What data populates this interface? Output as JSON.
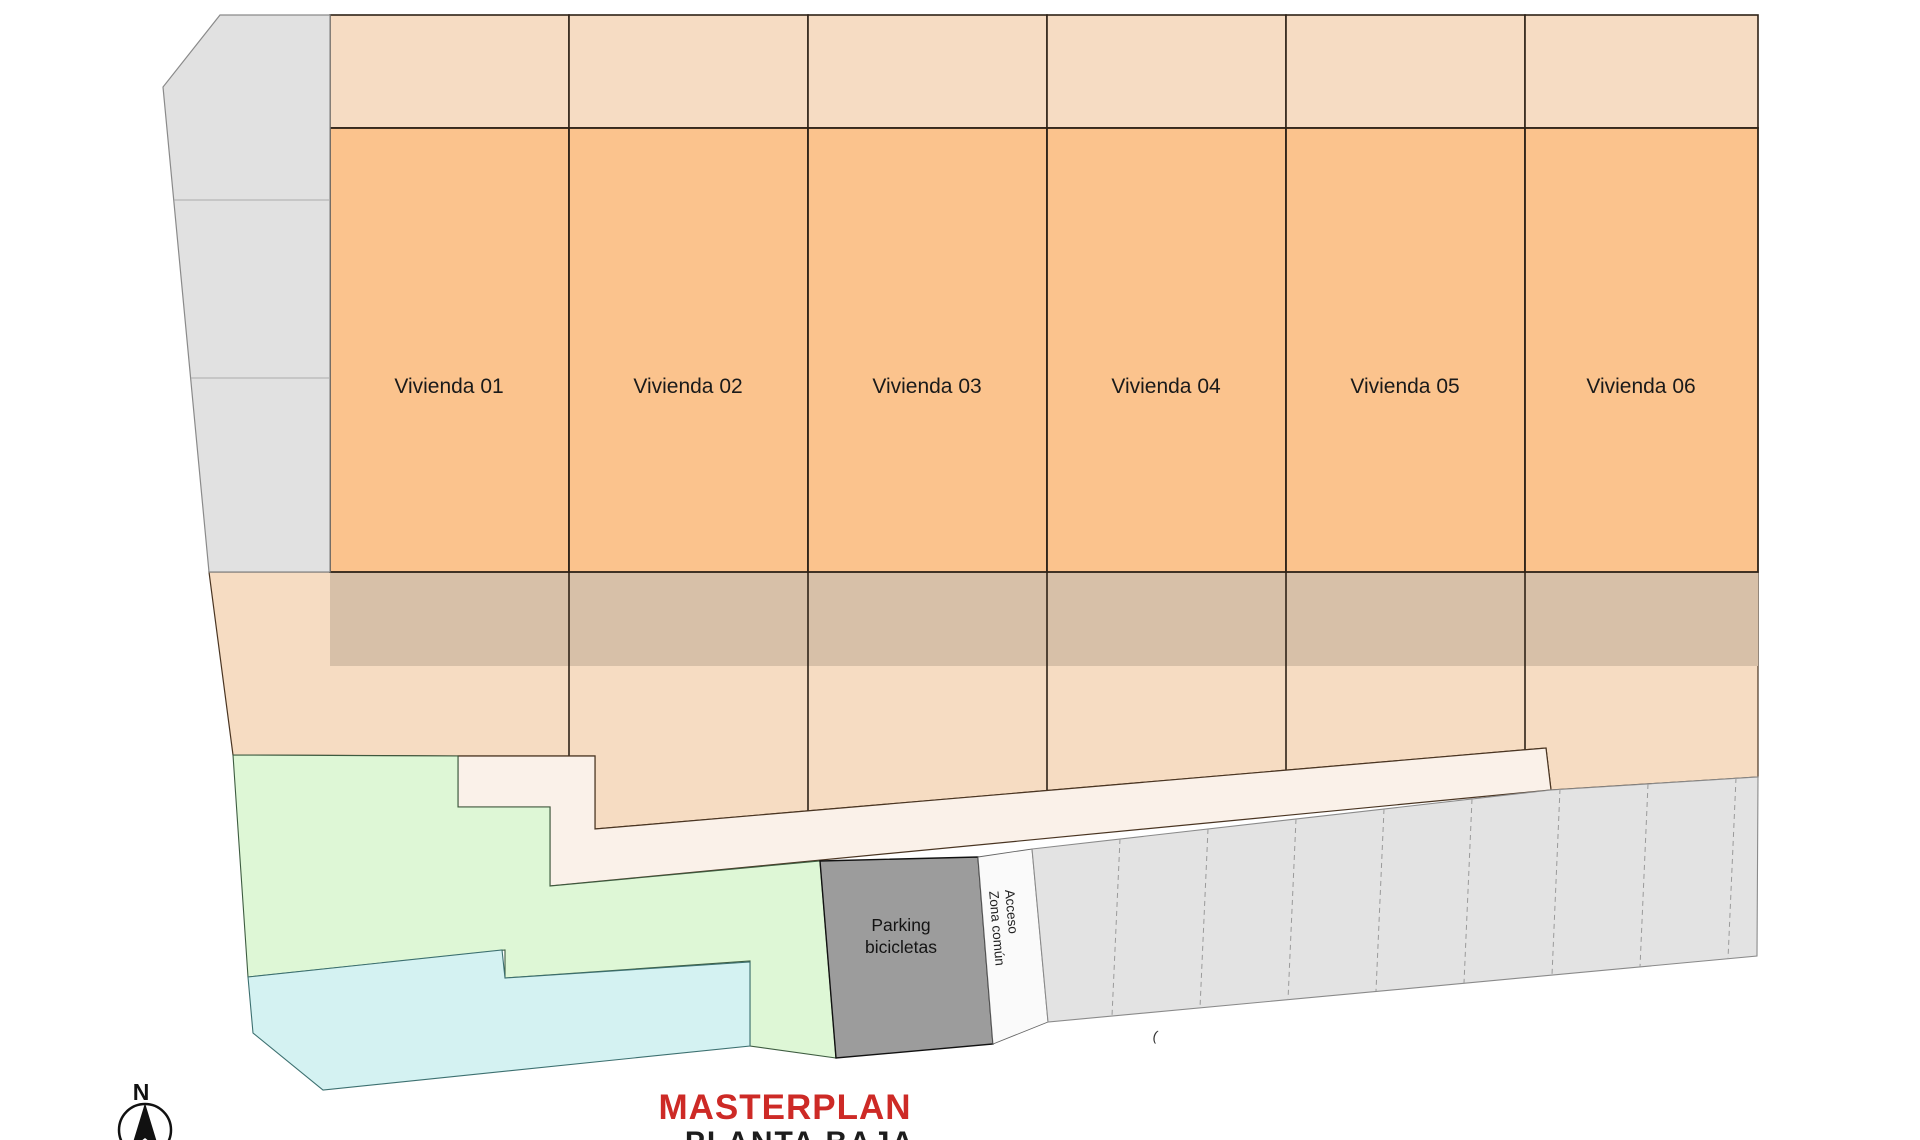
{
  "header": {
    "title": "MASTERPLAN",
    "subtitle": "PLANTA BAJA"
  },
  "compass": {
    "label": "N"
  },
  "units": [
    {
      "label": "Vivienda 01"
    },
    {
      "label": "Vivienda 02"
    },
    {
      "label": "Vivienda 03"
    },
    {
      "label": "Vivienda 04"
    },
    {
      "label": "Vivienda 05"
    },
    {
      "label": "Vivienda 06"
    }
  ],
  "bike_parking": {
    "line1": "Parking",
    "line2": "bicicletas"
  },
  "access": {
    "line1": "Acceso",
    "line2": "Zona común"
  },
  "annotation": {
    "tick": "("
  },
  "colors": {
    "unit_fill": "#fbc38d",
    "terrace_fill": "#f6dcc3",
    "band_fill": "#d7c0a8",
    "apron_fill": "#f6dcc2",
    "walkway_fill": "#faf1e9",
    "green_fill": "#def7d6",
    "pool_fill": "#d4f2f2",
    "bike_parking_fill": "#9c9c9c",
    "sidewalk_fill": "#e1e1e1",
    "parking_strip_fill": "#e3e3e3",
    "title_color": "#cd2a26",
    "outline": "#2e2217"
  }
}
